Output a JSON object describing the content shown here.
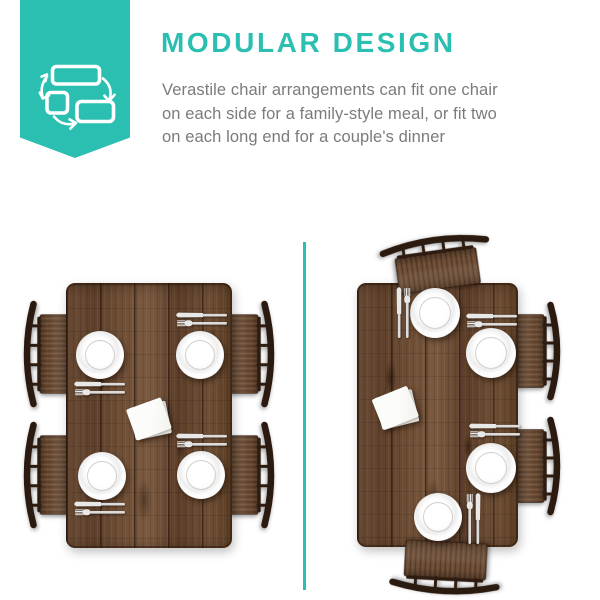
{
  "page": {
    "background": "#ffffff",
    "width": 600,
    "height": 600
  },
  "header": {
    "icon": "modular-rearrange-icon",
    "title": "MODULAR DESIGN",
    "body_lines": [
      "Verastile chair arrangements can fit one chair",
      "on each side for a family-style meal, or fit two",
      "on each long end for a couple's dinner"
    ]
  },
  "colors": {
    "accent_teal": "#2bbfb2",
    "body_text_gray": "#7b7b7b",
    "table_wood": "#6a4a32",
    "chair_back_dark": "#2e1c11",
    "seat_wood": "#6b4b33",
    "plate_white": "#ffffff",
    "napkin_white": "#fafaf8",
    "cutlery_silver": "#e8e8e8",
    "background": "#ffffff"
  },
  "scene": {
    "divider": {
      "x": 303,
      "y": 242,
      "w": 3,
      "h": 348
    },
    "panels": [
      {
        "name": "arrangement-one-chair-each-side",
        "table": {
          "x": 66,
          "y": 283,
          "w": 166,
          "h": 265
        },
        "chairs": [
          {
            "pos": "left-top",
            "cx": 45,
            "cy": 354,
            "len": 108,
            "rot": 0,
            "flip": false,
            "reach": 44
          },
          {
            "pos": "left-bottom",
            "cx": 45,
            "cy": 475,
            "len": 108,
            "rot": 0,
            "flip": false,
            "reach": 44
          },
          {
            "pos": "right-top",
            "cx": 253,
            "cy": 354,
            "len": 108,
            "rot": 0,
            "flip": true,
            "reach": 44
          },
          {
            "pos": "right-bottom",
            "cx": 253,
            "cy": 475,
            "len": 108,
            "rot": 0,
            "flip": true,
            "reach": 44
          }
        ],
        "plates": [
          {
            "cx": 100,
            "cy": 355,
            "r": 24
          },
          {
            "cx": 200,
            "cy": 355,
            "r": 24
          },
          {
            "cx": 102,
            "cy": 476,
            "r": 24
          },
          {
            "cx": 201,
            "cy": 475,
            "r": 24
          }
        ],
        "cutlery": [
          {
            "cx": 202,
            "cy": 319,
            "rot": 0,
            "flip": false
          },
          {
            "cx": 100,
            "cy": 388,
            "rot": 0,
            "flip": false
          },
          {
            "cx": 202,
            "cy": 440,
            "rot": 0,
            "flip": false
          },
          {
            "cx": 100,
            "cy": 508,
            "rot": 0,
            "flip": false
          }
        ],
        "napkins": [
          {
            "cx": 150,
            "cy": 420,
            "w": 37,
            "h": 33,
            "rot": -12
          }
        ]
      },
      {
        "name": "arrangement-two-chairs-each-long-end",
        "table": {
          "x": 357,
          "y": 283,
          "w": 161,
          "h": 264
        },
        "chairs": [
          {
            "pos": "top-end",
            "cx": 436,
            "cy": 258,
            "len": 112,
            "rot": 82,
            "flip": false,
            "reach": 52
          },
          {
            "pos": "bottom-end",
            "cx": 445,
            "cy": 573,
            "len": 112,
            "rot": -87,
            "flip": false,
            "reach": 52
          },
          {
            "pos": "right-top",
            "cx": 539,
            "cy": 351,
            "len": 100,
            "rot": 0,
            "flip": true,
            "reach": 44
          },
          {
            "pos": "right-bottom",
            "cx": 539,
            "cy": 466,
            "len": 100,
            "rot": 0,
            "flip": true,
            "reach": 44
          }
        ],
        "plates": [
          {
            "cx": 435,
            "cy": 313,
            "r": 25
          },
          {
            "cx": 491,
            "cy": 353,
            "r": 25
          },
          {
            "cx": 491,
            "cy": 468,
            "r": 25
          },
          {
            "cx": 438,
            "cy": 517,
            "r": 24
          }
        ],
        "cutlery": [
          {
            "cx": 403,
            "cy": 313,
            "rot": 90,
            "flip": true
          },
          {
            "cx": 492,
            "cy": 320,
            "rot": 0,
            "flip": false
          },
          {
            "cx": 495,
            "cy": 430,
            "rot": 0,
            "flip": false
          },
          {
            "cx": 474,
            "cy": 519,
            "rot": 90,
            "flip": false
          }
        ],
        "napkins": [
          {
            "cx": 397,
            "cy": 409,
            "w": 38,
            "h": 33,
            "rot": -14
          }
        ]
      }
    ]
  }
}
